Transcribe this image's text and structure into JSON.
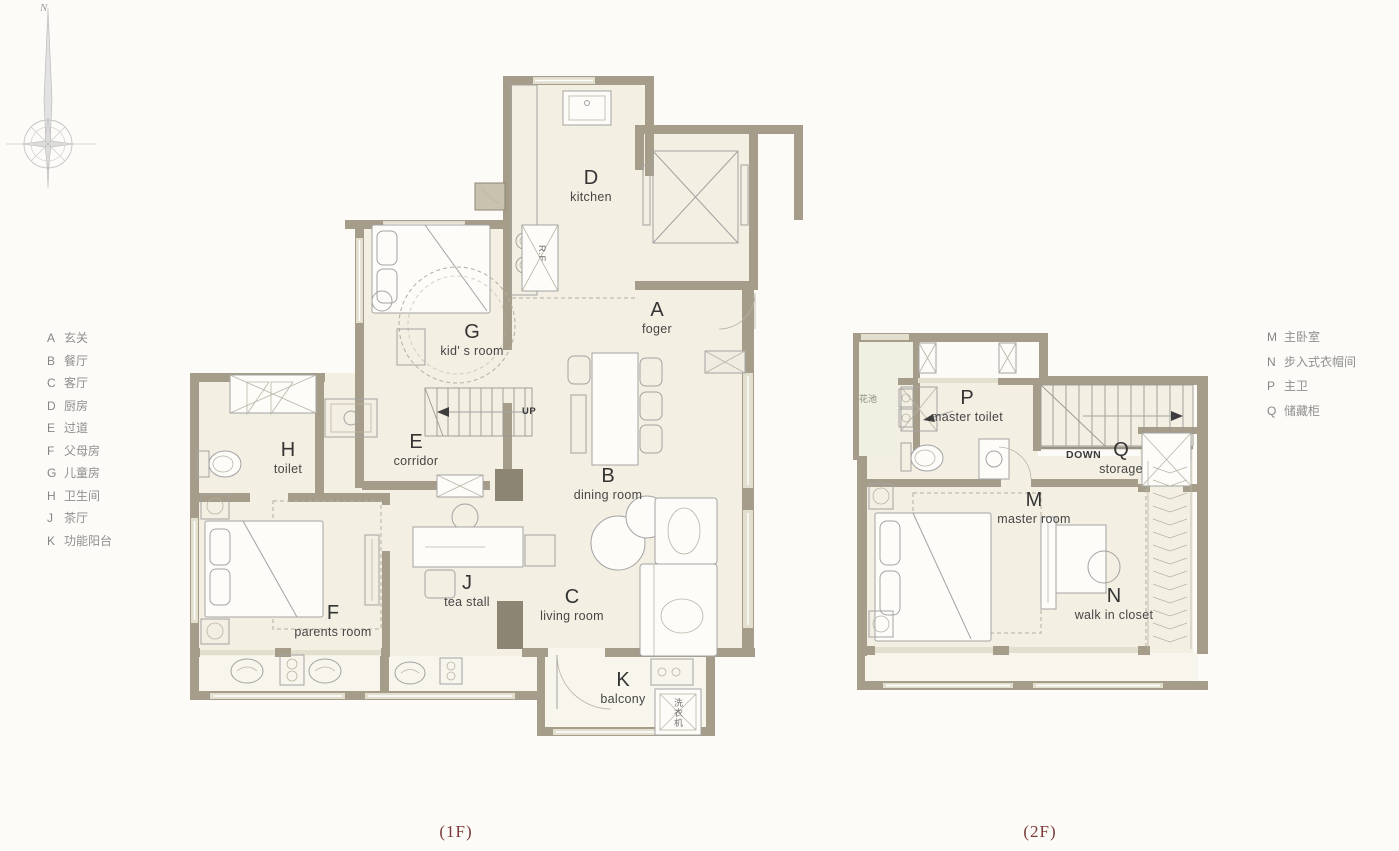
{
  "compass": {
    "north_label": "N"
  },
  "legend_left": {
    "items": [
      {
        "letter": "A",
        "label": "玄关"
      },
      {
        "letter": "B",
        "label": "餐厅"
      },
      {
        "letter": "C",
        "label": "客厅"
      },
      {
        "letter": "D",
        "label": "厨房"
      },
      {
        "letter": "E",
        "label": "过道"
      },
      {
        "letter": "F",
        "label": "父母房"
      },
      {
        "letter": "G",
        "label": "儿童房"
      },
      {
        "letter": "H",
        "label": "卫生间"
      },
      {
        "letter": "J",
        "label": "茶厅"
      },
      {
        "letter": "K",
        "label": "功能阳台"
      }
    ]
  },
  "legend_right": {
    "items": [
      {
        "letter": "M",
        "label": "主卧室"
      },
      {
        "letter": "N",
        "label": "步入式衣帽间"
      },
      {
        "letter": "P",
        "label": "主卫"
      },
      {
        "letter": "Q",
        "label": "储藏柜"
      }
    ]
  },
  "floor1": {
    "caption": "(1F)",
    "rooms": {
      "kitchen": {
        "letter": "D",
        "name": "kitchen"
      },
      "foyer": {
        "letter": "A",
        "name": "foger"
      },
      "kids_room": {
        "letter": "G",
        "name": "kid' s room"
      },
      "toilet": {
        "letter": "H",
        "name": "toilet"
      },
      "corridor": {
        "letter": "E",
        "name": "corridor"
      },
      "dining_room": {
        "letter": "B",
        "name": "dining room"
      },
      "tea_stall": {
        "letter": "J",
        "name": "tea stall"
      },
      "living_room": {
        "letter": "C",
        "name": "living room"
      },
      "parents_room": {
        "letter": "F",
        "name": "parents room"
      },
      "balcony": {
        "letter": "K",
        "name": "balcony"
      }
    },
    "annotations": {
      "stairs_up": "UP",
      "fridge": "R.F",
      "washing_machine": "洗衣机"
    }
  },
  "floor2": {
    "caption": "(2F)",
    "rooms": {
      "master_toilet": {
        "letter": "P",
        "name": "master toilet"
      },
      "storage": {
        "letter": "Q",
        "name": "storage"
      },
      "master_room": {
        "letter": "M",
        "name": "master room"
      },
      "walk_in_closet": {
        "letter": "N",
        "name": "walk in closet"
      }
    },
    "annotations": {
      "stairs_down": "DOWN",
      "planter": "花池"
    }
  },
  "colors": {
    "wall": "#a59c8a",
    "floor": "#f3efe2",
    "caption": "#7c3a3a"
  }
}
